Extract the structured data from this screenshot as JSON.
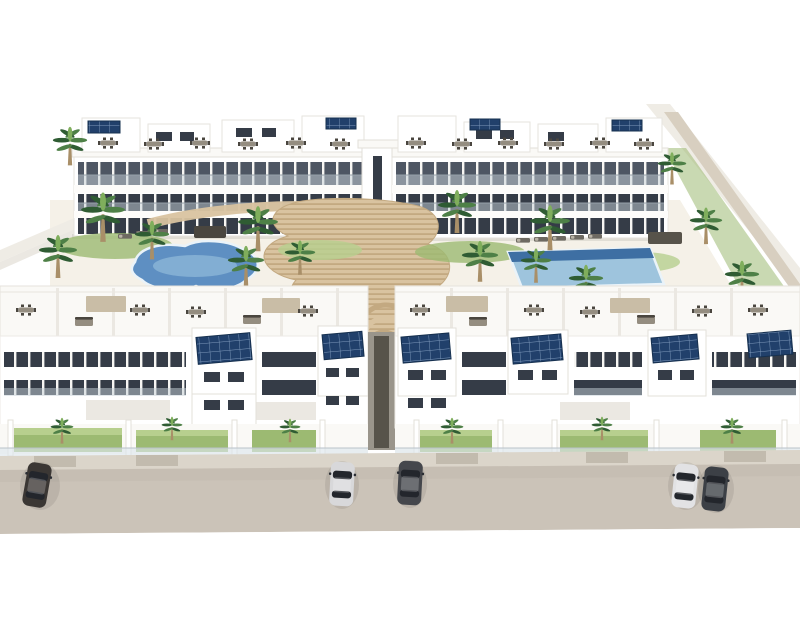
{
  "title": "Aerial 3D architectural rendering of a white Mediterranean-style apartment complex with two swimming pools, palm-filled courtyard, rooftop terraces with solar panels, and cars parked on the street in front",
  "image_type": "architectural-render",
  "colors": {
    "window_dark": "#353c47",
    "window_mid": "#4e5663",
    "glass_railing": "#c7d2da",
    "solar_panel": "#21406b",
    "solar_grid": "#7e99bb",
    "deck_wood": "#d9c3a0",
    "deck_stripe": "#c3a981",
    "pool_water": "#5e8fc2",
    "pool_water_light": "#9ec4dd",
    "pool_deep": "#3e6fa3",
    "grass": "#9cba72",
    "grass_light": "#b7cf8e",
    "street": "#cbc3b8",
    "sidewalk": "#dbd5ca",
    "courtyard": "#f5f1e8",
    "palm_trunk": "#a98f68",
    "palm_mid": "#4e8047",
    "palm_dark": "#2f5c33",
    "palm_light": "#7fae5c",
    "furniture": "#4a463f",
    "furniture_light": "#948d80",
    "canopy": "#c9bda6"
  },
  "scene": {
    "back_buildings": [
      {
        "label": "back-left apartment block",
        "features": "3 storeys, glass balconies, rooftop penthouse terraces with outdoor furniture, rooftop solar panels"
      },
      {
        "label": "back-right apartment block",
        "features": "3 storeys, glass balconies, rooftop penthouse terraces with outdoor furniture, rooftop solar panels"
      }
    ],
    "center": {
      "label": "central stair tower and curved timber deck staircase linking the two courtyards"
    },
    "courtyard": {
      "pools": [
        {
          "label": "freeform kidney-shaped pool",
          "water": "#5e8fc2"
        },
        {
          "label": "rectangular lap pool with sun loungers",
          "water": "#9ec4dd"
        }
      ],
      "vegetation": "palm trees and low tropical planting throughout the landscaped courtyard"
    },
    "front_buildings": [
      {
        "label": "front-left terraced block",
        "features": "roof terraces with dining sets, solar-panel towers, ribbon windows, private lawns with glass balustrade"
      },
      {
        "label": "front-right terraced block",
        "features": "roof terraces with dining sets, solar-panel towers, ribbon windows, private lawns with glass balustrade"
      }
    ],
    "street": {
      "label": "beige asphalt street in front of the complex",
      "cars": [
        {
          "label": "dark sedan far left",
          "color": "#3b3734"
        },
        {
          "label": "silver sedan center-left",
          "color": "#d8d8da"
        },
        {
          "label": "dark grey sedan center",
          "color": "#45474c"
        },
        {
          "label": "white sedan right pair front",
          "color": "#e2e2e4"
        },
        {
          "label": "dark sedan right pair rear",
          "color": "#3c4046"
        }
      ]
    }
  }
}
